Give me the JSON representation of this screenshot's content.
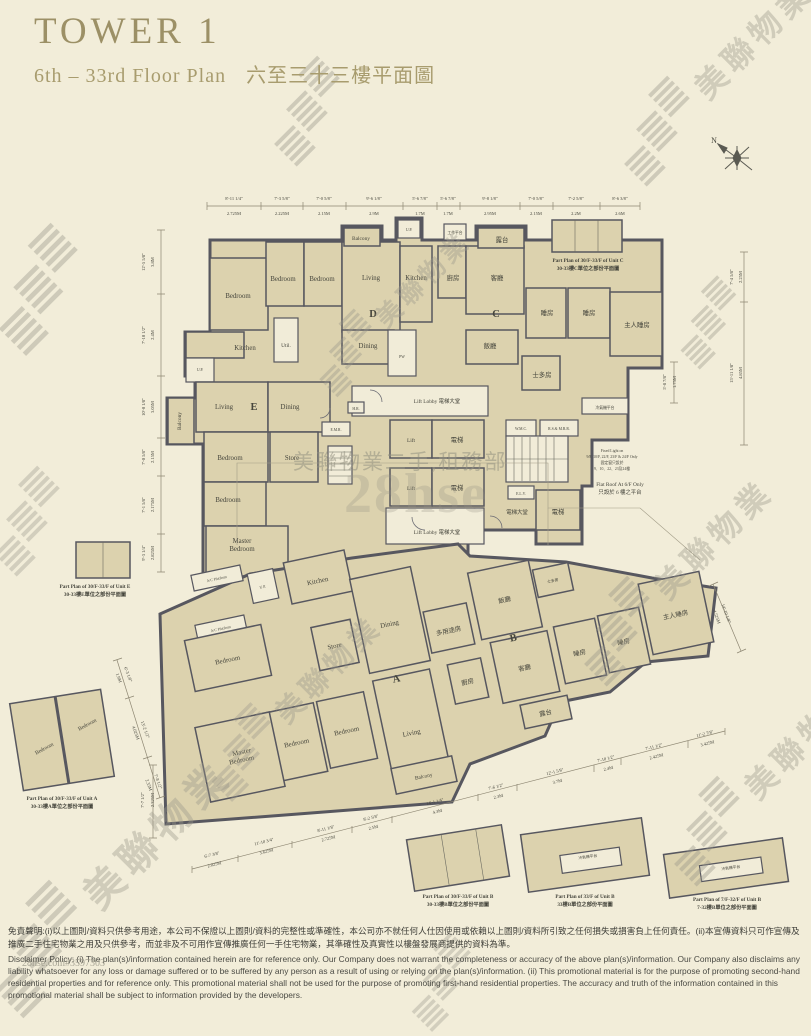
{
  "page": {
    "title": "TOWER 1",
    "subtitle_en": "6th – 33rd Floor Plan",
    "subtitle_zh": "六至三十三樓平面圖"
  },
  "compass": {
    "label": "N"
  },
  "plan": {
    "units": {
      "a": "A",
      "b": "B",
      "c": "C",
      "d": "D",
      "e": "E"
    },
    "labels": {
      "bedroom": "Bedroom",
      "living": "Living",
      "dining": "Dining",
      "kitchen": "Kitchen",
      "store": "Store",
      "util": "Util.",
      "up": "U.P.",
      "balcony": "Balcony",
      "master1": "Master",
      "master2": "Bedroom",
      "pw": "PW",
      "lift": "Lift",
      "lift_lobby": "Lift Lobby 電梯大堂",
      "lift_zh": "電梯",
      "lift_lobby_zh": "電梯大堂",
      "kitchen_zh": "廚房",
      "living_zh": "客廳",
      "dining_zh": "飯廳",
      "bedroom_zh": "睡房",
      "master_zh": "主人睡房",
      "balcony_zh": "露台",
      "store_zh": "士多房",
      "multi_zh": "多用途房",
      "work_platform_zh": "工作平台",
      "ac_platform_zh": "冷氣機平台",
      "ac_platform_en": "A/C Platform",
      "wmc": "W.M.C.",
      "rsmrr": "R.S.& M.R.R.",
      "elv": "E.L.V.",
      "hr": "H.R.",
      "emr": "E.M.R."
    }
  },
  "notes": {
    "flat_roof_en": "Flat Roof At 6/F Only",
    "flat_roof_zh": "只設於 6 樓之平台",
    "fixed_light_1": "Fixed Light on",
    "fixed_light_2": "9/F, 10/F, 22/F, 23/F & 24/F Only",
    "fixed_light_3": "固定窗只設於",
    "fixed_light_4": "9、10、22、23及24樓"
  },
  "part_plans": {
    "e": {
      "en": "Part Plan of 30/F-33/F of Unit E",
      "zh": "30-33樓E單位之部份平面圖"
    },
    "c": {
      "en": "Part Plan of 30/F-33/F of Unit C",
      "zh": "30-33樓C單位之部份平面圖"
    },
    "a": {
      "en": "Part Plan of 30/F-33/F of Unit A",
      "zh": "30-33樓A單位之部份平面圖"
    },
    "b1": {
      "en": "Part Plan of 30/F-33/F of Unit B",
      "zh": "30-33樓B單位之部份平面圖"
    },
    "b2": {
      "en": "Part Plan of 33/F of Unit B",
      "zh": "33樓B單位之部份平面圖"
    },
    "b3": {
      "en": "Part Plan of 7/F-32/F of Unit B",
      "zh": "7-32樓B單位之部份平面圖"
    }
  },
  "dims": {
    "top": [
      {
        "ft": "8'-11 1/4\"",
        "m": "2.725M"
      },
      {
        "ft": "7'-3 5/8\"",
        "m": "2.225M"
      },
      {
        "ft": "7'-0 5/8\"",
        "m": "2.15M"
      },
      {
        "ft": "9'-6 1/8\"",
        "m": "2.9M"
      },
      {
        "ft": "5'-6 7/8\"",
        "m": "1.7M"
      },
      {
        "ft": "5'-6 7/8\"",
        "m": "1.7M"
      },
      {
        "ft": "9'-8 1/8\"",
        "m": "2.95M"
      },
      {
        "ft": "7'-0 5/8\"",
        "m": "2.15M"
      },
      {
        "ft": "7'-2 5/8\"",
        "m": "2.2M"
      },
      {
        "ft": "8'-6 3/8\"",
        "m": "2.6M"
      }
    ],
    "left": [
      {
        "ft": "12'-5 5/8\"",
        "m": "3.8M"
      },
      {
        "ft": "7'-10 1/2\"",
        "m": "2.4M"
      },
      {
        "ft": "10'-0 1/8\"",
        "m": "3.05M"
      },
      {
        "ft": "7'-0 5/8\"",
        "m": "2.15M"
      },
      {
        "ft": "7'-1 5/8\"",
        "m": "2.175M"
      },
      {
        "ft": "9'-3 1/4\"",
        "m": "2.825M"
      }
    ],
    "right_c": [
      {
        "ft": "7'-4 5/8\"",
        "m": "2.25M"
      },
      {
        "ft": "15'-11 1/8\"",
        "m": "4.85M"
      }
    ],
    "right_mid": [
      {
        "ft": "5'-8 7/8\"",
        "m": "1.75M"
      }
    ],
    "right_b": [
      {
        "ft": "14'-10 1/8\"",
        "m": "4.525M"
      }
    ],
    "bottom": [
      {
        "ft": "6'-7 3/8\"",
        "m": "2.025M"
      },
      {
        "ft": "11'-10 3/4\"",
        "m": "3.625M"
      },
      {
        "ft": "8'-11 1/8\"",
        "m": "2.725M"
      },
      {
        "ft": "8'-2 5/8\"",
        "m": "2.5M"
      },
      {
        "ft": "14'-1 1/4\"",
        "m": "4.3M"
      },
      {
        "ft": "7'-6 1/2\"",
        "m": "2.3M"
      },
      {
        "ft": "12'-1 5/8\"",
        "m": "3.7M"
      },
      {
        "ft": "7'-10 1/2\"",
        "m": "2.4M"
      },
      {
        "ft": "7'-11 1/2\"",
        "m": "2.425M"
      },
      {
        "ft": "11'-2 7/8\"",
        "m": "3.425M"
      }
    ],
    "left_bottom": [
      {
        "ft": "7'-7 1/2\"",
        "m": "2.325M"
      }
    ],
    "part_a": [
      {
        "ft": "6'-3 1/8\"",
        "m": "1.9M"
      },
      {
        "ft": "13'-2 1/2\"",
        "m": "4.025M"
      },
      {
        "ft": "7'-8 1/2\"",
        "m": "2.35M"
      }
    ]
  },
  "watermarks": {
    "brand_zh": "美聯物業",
    "brand_en": "MIDLAND REALTY",
    "dept": "美聯物業二手,租務部",
    "site": "28hse.com#3597303",
    "site_big": "28hse"
  },
  "disclaimer": {
    "zh": "免責聲明:(i)以上圖則/資料只供參考用途，本公司不保證以上圖則/資料的完整性或準確性，本公司亦不就任何人仕因使用或依賴以上圖則/資料所引致之任何損失或損害負上任何責任。(ii)本宣傳資料只可作宣傳及推廣二手住宅物業之用及只供參考，而並非及不可用作宣傳推廣任何一手住宅物業，其準確性及真實性以樓盤發展商提供的資料為準。",
    "en": "Disclaimer Policy: (i) The plan(s)/information contained herein are for reference only. Our Company does not warrant the completeness or accuracy of the above plan(s)/information. Our Company also disclaims any liability whatsoever for any loss or damage suffered or to be suffered by any person as a result of using or relying on the plan(s)/information. (ii) This promotional material is for the purpose of promoting second-hand residential properties and for reference only. This promotional material shall not be used for the purpose of promoting first-hand residential properties. The accuracy and truth of the information contained in this promotional material shall be subject to information provided by the developers."
  }
}
